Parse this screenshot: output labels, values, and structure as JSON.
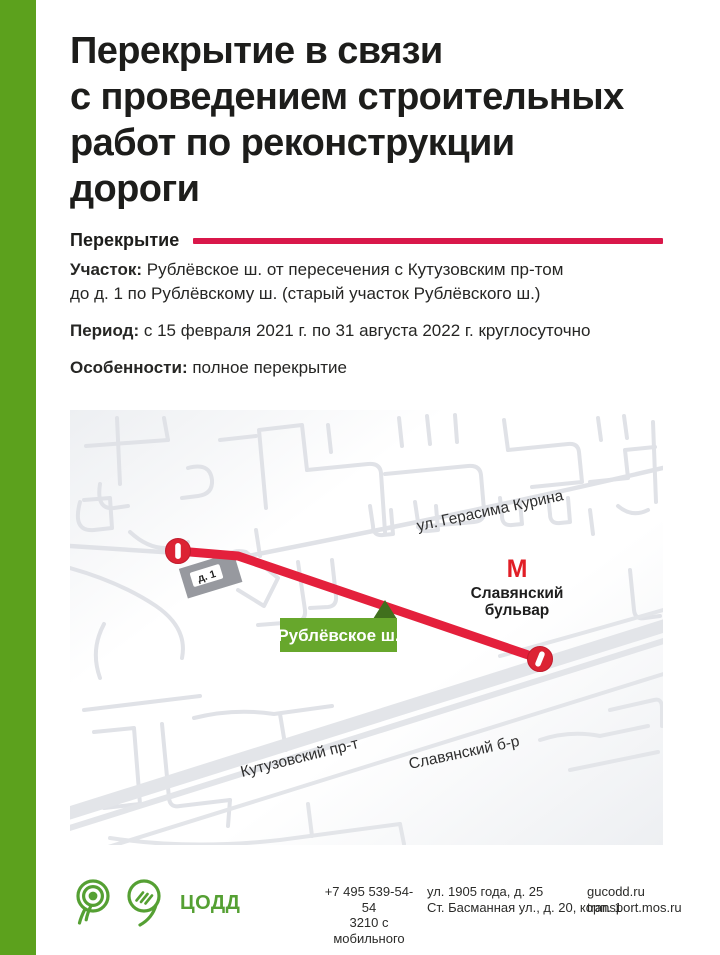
{
  "page": {
    "title_lines": [
      "Перекрытие в связи",
      "с проведением строительных",
      "работ по реконструкции",
      "дороги"
    ],
    "section_label": "Перекрытие"
  },
  "details": [
    {
      "label": "Участок:",
      "lines": [
        "Рублёвское ш. от пересечения с Кутузовским пр-том",
        "до д. 1 по Рублёвскому ш. (старый участок Рублёвского ш.)"
      ]
    },
    {
      "label": "Период:",
      "lines": [
        "с 15 февраля 2021 г. по 31 августа 2022 г. круглосуточно"
      ]
    },
    {
      "label": "Особенности:",
      "lines": [
        "полное перекрытие"
      ]
    }
  ],
  "map": {
    "road_closed_label": "Рублёвское ш.",
    "building_label": "д. 1",
    "metro_icon": "М",
    "metro_name_line1": "Славянский",
    "metro_name_line2": "бульвар",
    "street_gerasima_kurina": "ул. Герасима Курина",
    "street_kutuzovsky": "Кутузовский пр-т",
    "street_slavyansky": "Славянский б-р"
  },
  "footer": {
    "org_name": "ЦОДД",
    "phone_line1": "+7 495 539-54-54",
    "phone_line2": "3210 с мобильного",
    "address_line1": "ул. 1905 года, д. 25",
    "address_line2": "Ст. Басманная ул., д. 20, корп. 1",
    "site_line1": "gucodd.ru",
    "site_line2": "transport.mos.ru"
  },
  "colors": {
    "brand_green": "#5ca11d",
    "logo_green": "#55a033",
    "accent_red": "#d9174a",
    "route_red": "#e4203c",
    "metro_red": "#e11e26",
    "closure_label_green": "#67a72c",
    "closure_pointer_green": "#40701d",
    "street_gray": "#e0e2e7"
  }
}
